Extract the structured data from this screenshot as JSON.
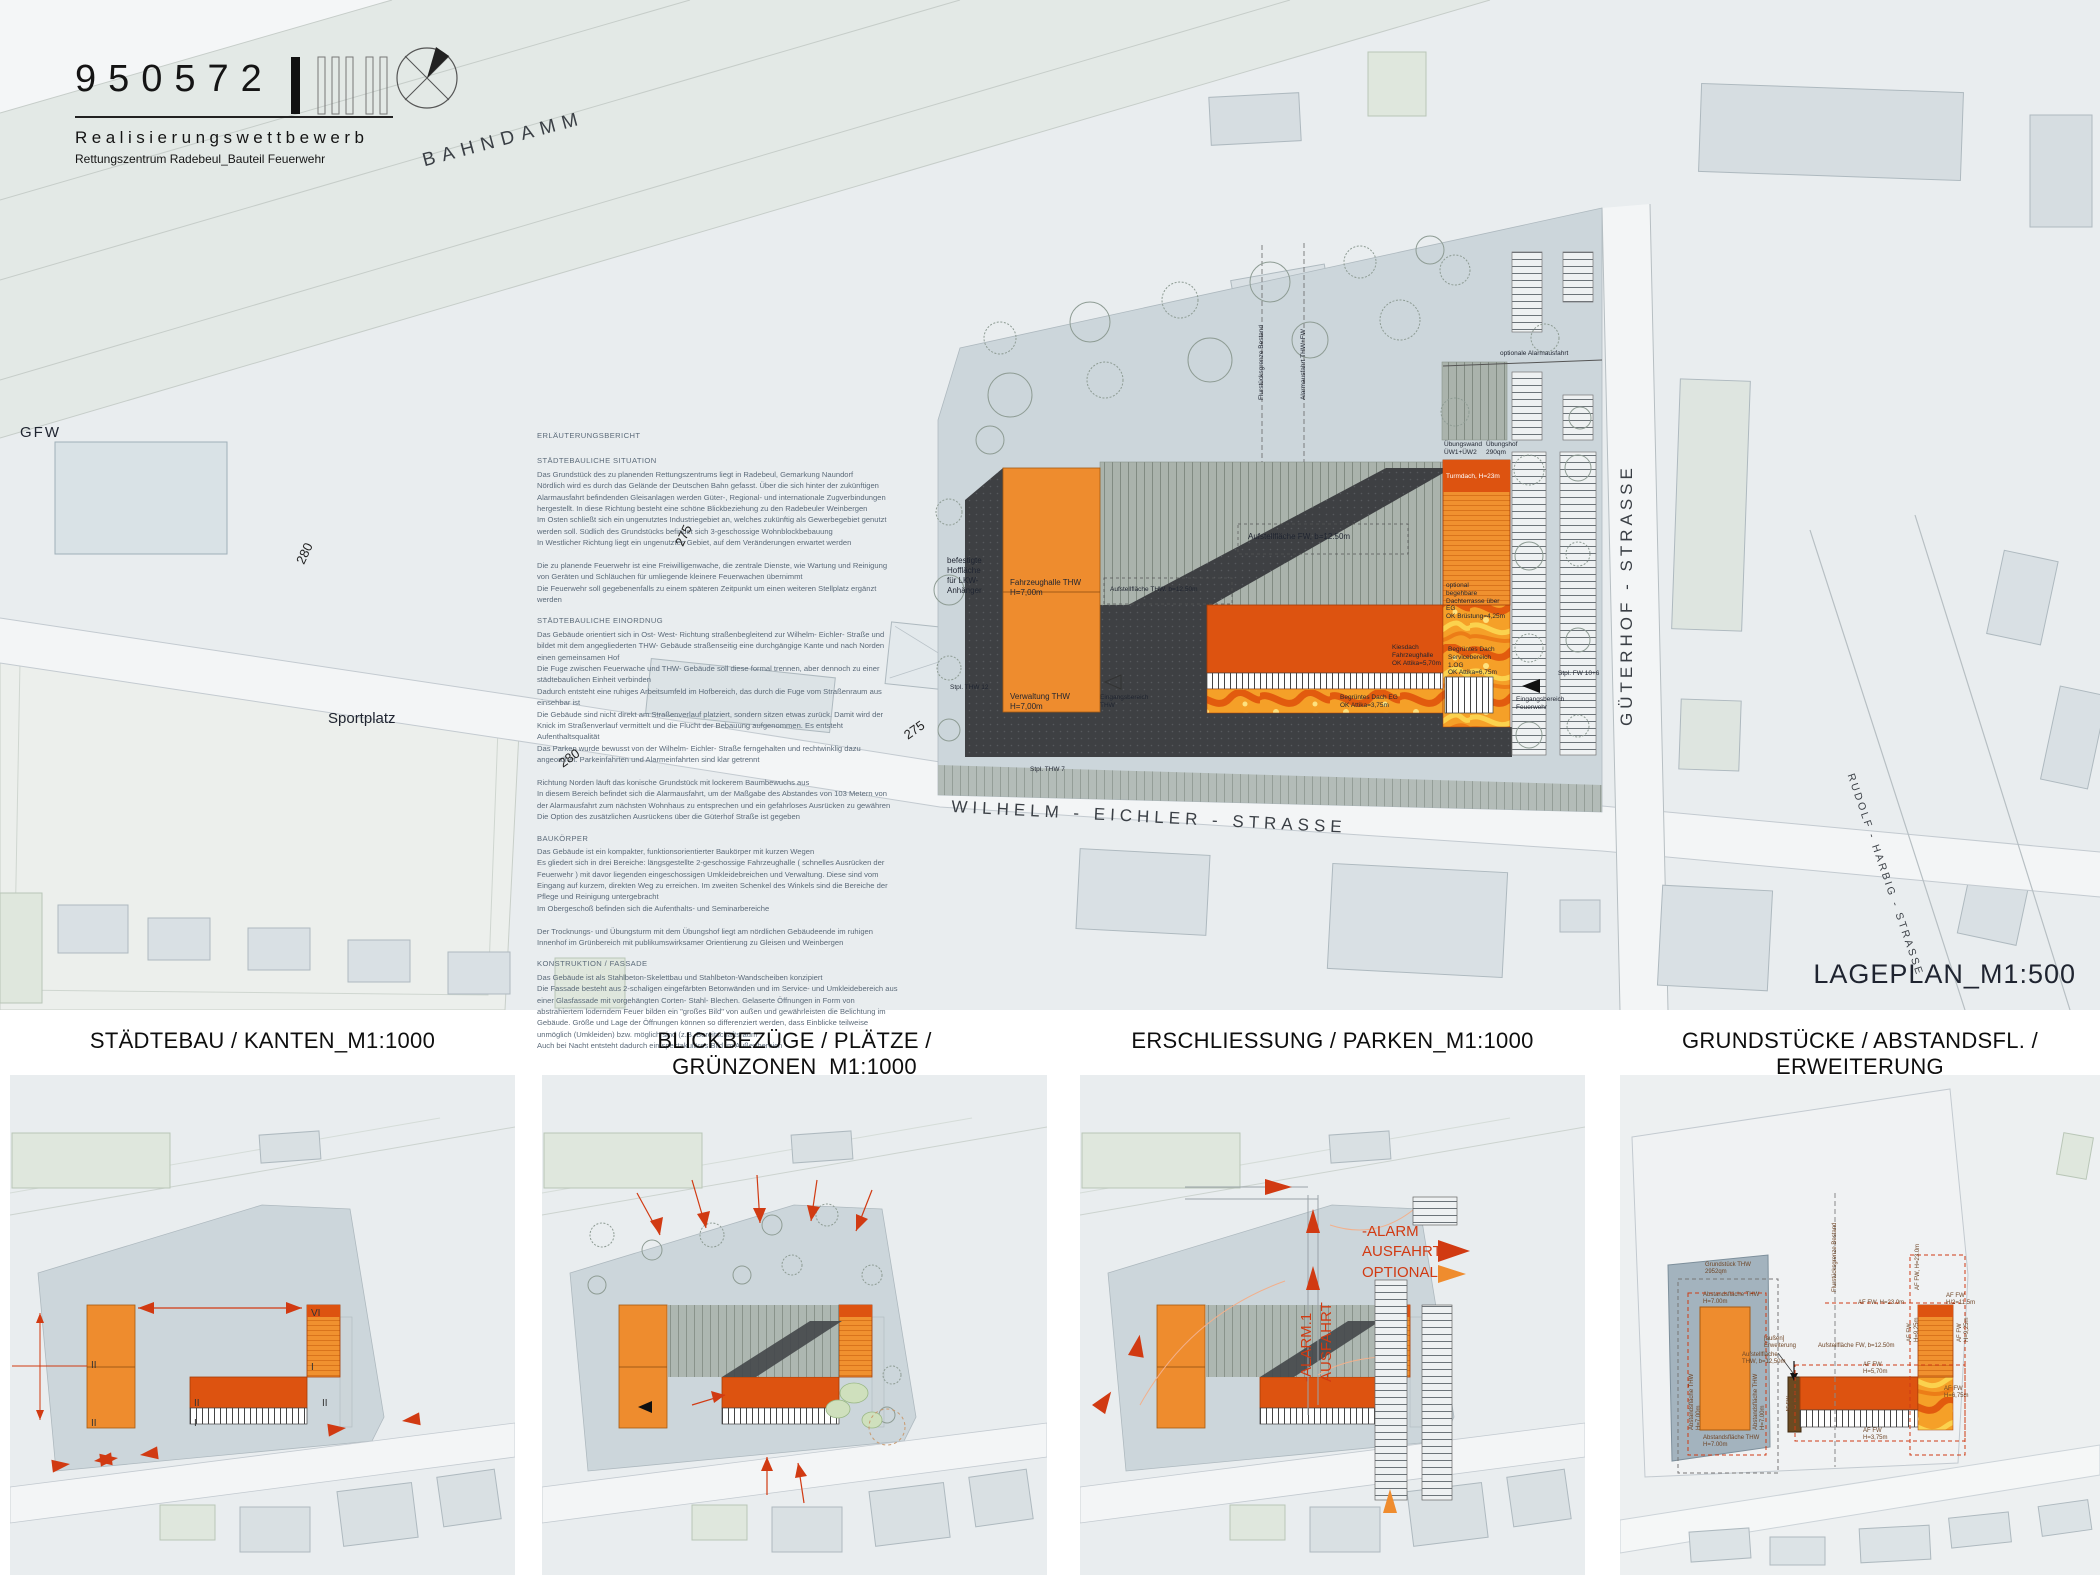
{
  "header": {
    "number": "950572",
    "competition": "Realisierungswettbewerb",
    "project": "Rettungszentrum Radebeul_Bauteil Feuerwehr"
  },
  "main_plan": {
    "scale_label": "LAGEPLAN_M1:500",
    "streets": {
      "bahndamm": "BAHNDAMM",
      "gfw": "GFW",
      "sportplatz": "Sportplatz",
      "wilhelm_eichler": "WILHELM - EICHLER - STRASSE",
      "gueterhof": "GÜTERHOF - STRASSE",
      "rudolf_harbig": "RUDOLF - HARBIG - STRASSE"
    },
    "contours": {
      "c280": "280",
      "c275": "275"
    },
    "annotations": {
      "befestigte": "befestigte\nHoffläche\nfür LKW-Anhänger",
      "fahrzeughalle_thw": "Fahrzeughalle THW\nH=7,00m",
      "verwaltung_thw": "Verwaltung THW\nH=7,00m",
      "stpl_thw12": "Stpl. THW 12",
      "stpl_thw7": "Stpl. THW 7",
      "stpl_fw": "Stpl. FW 10+6",
      "eingang_thw": "Eingangsbereich\nTHW",
      "eingang_fw": "Eingangsbereich\nFeuerwehr",
      "aufstell_thw": "Aufstellfläche THW, b=12.50m",
      "aufstell_fw": "Aufstellfläche FW, b=12.50m",
      "uebungswand": "Übungswand\nÜW1+ÜW2",
      "uebungshof": "Übungshof\n290qm",
      "turmdach": "Turmdach, H=23m",
      "dachterrasse": "optional\nbegehbare Dachterrasse über EG\nOK Brüstung=4,25m",
      "kiesdach": "Kiesdach\nFahrzeughalle\nOK Attika=5,70m",
      "begruent_og": "Begrüntes Dach\nServicebereich 1.OG\nOK Attika=6,75m",
      "begruent_eg": "Begrüntes Dach EG\nOK Attika=3,75m",
      "opt_alarm": "optionale Alarmausfahrt",
      "grenze": "Flurstücksgrenze Bestand",
      "alarmausfahrt": "Alarmausfahrt THW+FW"
    }
  },
  "report": {
    "title": "ERLÄUTERUNGSBERICHT",
    "sections": [
      {
        "heading": "STÄDTEBAULICHE SITUATION",
        "body": "Das Grundstück des zu planenden Rettungszentrums liegt in Radebeul, Gemarkung Naundorf\nNördlich wird es durch das Gelände der Deutschen Bahn gefasst. Über die sich hinter der zukünftigen Alarmausfahrt befindenden Gleisanlagen werden Güter-, Regional- und internationale Zugverbindungen hergestellt. In diese Richtung besteht eine schöne Blickbeziehung zu den Radebeuler Weinbergen\nIm Osten schließt sich ein ungenutztes Industriegebiet an, welches zukünftig als Gewerbegebiet genutzt werden soll. Südlich des Grundstücks befindet sich 3-geschossige Wohnblockbebauung\nIn Westlicher Richtung liegt ein ungenutztes Gebiet, auf dem Veränderungen erwartet werden\n\nDie zu planende Feuerwehr ist eine Freiwilligenwache, die zentrale Dienste, wie Wartung und Reinigung von Geräten und Schläuchen für umliegende kleinere Feuerwachen übernimmt\nDie Feuerwehr soll gegebenenfalls zu einem späteren Zeitpunkt um einen weiteren Stellplatz ergänzt werden"
      },
      {
        "heading": "STÄDTEBAULICHE EINORDNUG",
        "body": "Das Gebäude orientiert sich in Ost- West- Richtung straßenbegleitend zur Wilhelm- Eichler- Straße und bildet mit dem angegliederten THW- Gebäude straßenseitig eine durchgängige Kante und nach Norden einen gemeinsamen Hof\nDie Fuge zwischen Feuerwache und THW- Gebäude soll diese formal trennen, aber dennoch zu einer städtebaulichen Einheit verbinden\nDadurch entsteht eine ruhiges Arbeitsumfeld im Hofbereich, das durch die Fuge vom Straßenraum aus einsehbar ist\nDie Gebäude sind nicht direkt am Straßenverlauf platziert, sondern sitzen etwas zurück. Damit wird der Knick im Straßenverlauf vermittelt und die Flucht der Bebauung aufgenommen. Es entsteht Aufenthaltsqualität\nDas Parken wurde bewusst von der Wilhelm- Eichler- Straße ferngehalten und rechtwinklig dazu angeordnet. Parkeinfahrten und Alarmeinfahrten sind klar getrennt\n\nRichtung Norden läuft das konische Grundstück mit lockerem Baumbewuchs aus\nIn diesem Bereich befindet sich die Alarmausfahrt, um der Maßgabe des Abstandes von 103 Metern von der Alarmausfahrt zum nächsten Wohnhaus zu entsprechen und ein gefahrloses Ausrücken zu gewähren\nDie Option des zusätzlichen Ausrückens über die Güterhof Straße ist gegeben"
      },
      {
        "heading": "BAUKÖRPER",
        "body": "Das Gebäude ist ein kompakter, funktionsorientierter Baukörper mit kurzen Wegen\nEs gliedert sich in drei Bereiche: längsgestellte 2-geschossige Fahrzeughalle ( schnelles Ausrücken der Feuerwehr ) mit davor liegenden eingeschossigen Umkleidebreichen und Verwaltung. Diese sind vom Eingang auf kurzem, direkten Weg zu erreichen. Im zweiten Schenkel des Winkels sind die Bereiche der Pflege und Reinigung untergebracht\nIm Obergeschoß befinden sich die Aufenthalts- und Seminarbereiche\n\nDer Trocknungs- und Übungsturm mit dem Übungshof liegt am nördlichen Gebäudeende im ruhigen Innenhof im Grünbereich mit publikumswirksamer Orientierung zu Gleisen und Weinbergen"
      },
      {
        "heading": "KONSTRUKTION / FASSADE",
        "body": "Das Gebäude ist als Stahlbeton-Skelettbau und Stahlbeton-Wandscheiben konzipiert\nDie Fassade besteht aus 2-schaligen eingefärbten Betonwänden und im Service- und Umkleidebereich aus einer Glasfassade mit vorgehängten Corten- Stahl- Blechen. Gelaserte Öffnungen in Form von abstrahiertem loderndem Feuer bilden ein \"großes Bild\" von außen und gewährleisten die Belichtung im Gebäude. Größe und Lage der Öffnungen können so differenziert werden, dass Einblicke teilweise unmöglich (Umkleiden) bzw. möglich sind (z.B. Bereitschaftsraum\nAuch bei Nacht entsteht dadurch ein spektakuläres Bild im Außenbereich"
      }
    ]
  },
  "panels": [
    {
      "title": "STÄDTEBAU / KANTEN_M1:1000",
      "marks": [
        "II",
        "II",
        "VI",
        "I",
        "II",
        "II",
        "I"
      ]
    },
    {
      "title": "BLICKBEZÜGE / PLÄTZE / GRÜNZONEN_M1:1000"
    },
    {
      "title": "ERSCHLIESSUNG / PARKEN_M1:1000",
      "labels": {
        "alarm1": "-ALARM.1\nAUSFAHRT",
        "alarm_optional": "-ALARM\nAUSFAHRT\nOPTIONAL"
      }
    },
    {
      "title": "GRUNDSTÜCKE / ABSTANDSFL. / ERWEITERUNG",
      "labels": {
        "grundstueck": "Grundstück THW\n2952qm",
        "abstand_thw": "Abstandsfläche THW\nH=7.00m",
        "af_fw_23": "AF FW, H=23.0m",
        "af_fw_half": "AF FW\nH/2=11.5m",
        "af_fw_vert23": "AF FW, H=23.0m",
        "af_fw_570": "AF FW\nH=5,70m",
        "af_fw_675": "AF FW\nH=6,75m",
        "af_fw_375": "AF FW\nH=3,75m",
        "af_fw_925": "AF FW\nH=9,25m",
        "af_fw_288": "AF FW\nH=2,88m",
        "aufstell_fw": "Aufstellfläche FW, b=12.50m",
        "aufstell_thw": "Aufstellfläche\nTHW, b=12,50m",
        "grenze": "Flurstücksgrenze Bestand",
        "erweiterung": "[außen]\nErweiterung"
      }
    }
  ],
  "colors": {
    "background": "#e9edef",
    "parcel": "#ccd6db",
    "orange": "#ee8c2e",
    "dark_orange": "#dd5310",
    "dark_courtyard": "#3e4043",
    "signal_red": "#d13a12",
    "green_area": "#dfe7dd"
  }
}
